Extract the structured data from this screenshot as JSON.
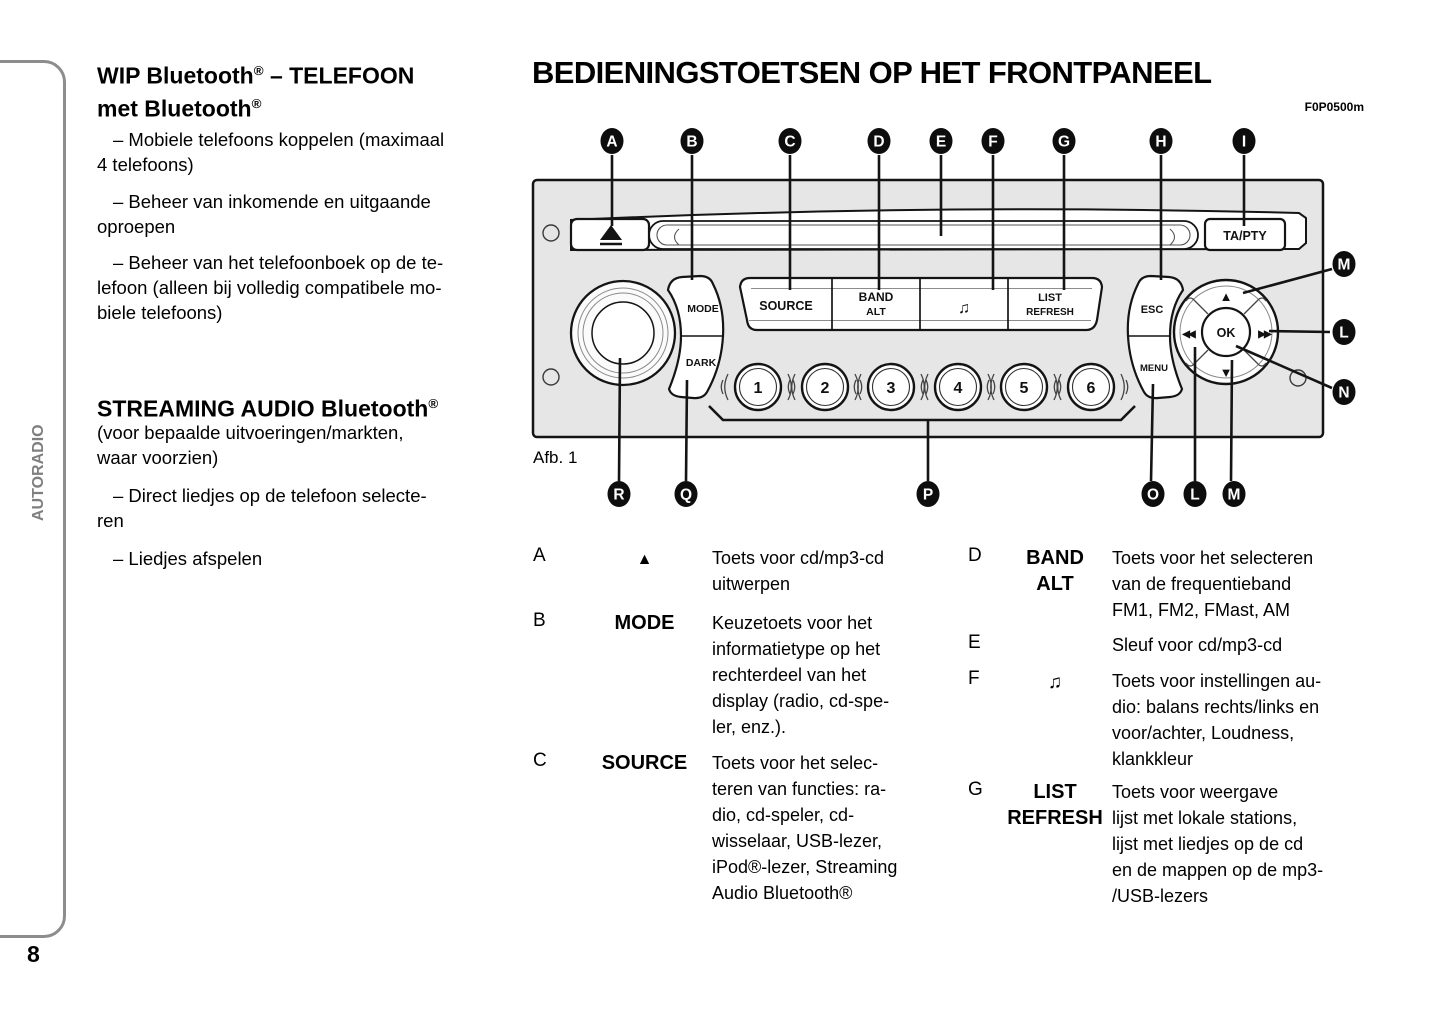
{
  "page": {
    "number": "8",
    "side_label": "AUTORADIO",
    "figure_caption": "Afb. 1",
    "figure_code": "F0P0500m"
  },
  "left_column": {
    "h1": {
      "b1": "WIP Bluetooth",
      "s1": "®",
      "b2": " – TELEFOON",
      "b3": "met Bluetooth",
      "s2": "®"
    },
    "p1": "– Mobiele telefoons koppelen (maximaal\n4 telefoons)",
    "p2": "– Beheer van inkomende en uitgaande\noproepen",
    "p3": "– Beheer van het telefoonboek op de te-\nlefoon (alleen bij volledig compatibele mo-\nbiele telefoons)",
    "h2": {
      "b1": "STREAMING AUDIO Bluetooth",
      "s1": "®"
    },
    "p4": "(voor bepaalde uitvoeringen/markten,\nwaar voorzien)",
    "p5": "– Direct liedjes op de telefoon selecte-\nren",
    "p6": "– Liedjes afspelen"
  },
  "main": {
    "title": "BEDIENINGSTOETSEN OP HET FRONTPANEEL"
  },
  "radio": {
    "eject_symbol": "▲",
    "ta_pty": "TA/PTY",
    "mode": "MODE",
    "dark": "DARK",
    "source": "SOURCE",
    "band": "BAND",
    "alt": "ALT",
    "note": "♫",
    "list": "LIST",
    "refresh": "REFRESH",
    "esc": "ESC",
    "menu": "MENU",
    "ok": "OK",
    "numbers": [
      "1",
      "2",
      "3",
      "4",
      "5",
      "6"
    ],
    "arrow_up": "▲",
    "arrow_down": "▼",
    "arrow_left": "◀◀",
    "arrow_right": "▶▶"
  },
  "callouts": {
    "top": [
      "A",
      "B",
      "C",
      "D",
      "E",
      "F",
      "G",
      "H",
      "I"
    ],
    "right": [
      "M",
      "L",
      "N"
    ],
    "bottom": [
      "R",
      "Q",
      "P",
      "O",
      "L",
      "M"
    ]
  },
  "definitions": {
    "rows": [
      {
        "letter": "A",
        "label": "▲",
        "desc": "Toets voor cd/mp3-cd\nuitwerpen"
      },
      {
        "letter": "B",
        "label": "MODE",
        "desc": "Keuzetoets voor het\ninformatietype op het\nrechterdeel van het\ndisplay (radio, cd-spe-\nler, enz.)."
      },
      {
        "letter": "C",
        "label": "SOURCE",
        "desc": "Toets voor het selec-\nteren van functies: ra-\ndio, cd-speler, cd-\nwisselaar, USB-lezer,\niPod®-lezer, Streaming\nAudio Bluetooth®"
      },
      {
        "letter": "D",
        "label": "BAND\nALT",
        "desc": "Toets voor het selecteren\nvan de frequentieband\nFM1, FM2, FMast, AM"
      },
      {
        "letter": "E",
        "label": "",
        "desc": "Sleuf voor cd/mp3-cd"
      },
      {
        "letter": "F",
        "label": "♫",
        "desc": "Toets voor instellingen au-\ndio: balans rechts/links en\nvoor/achter, Loudness,\nklankkleur"
      },
      {
        "letter": "G",
        "label": "LIST\nREFRESH",
        "desc": "Toets voor weergave\nlijst met lokale stations,\nlijst met liedjes op de cd\nen de mappen op de mp3-\n/USB-lezers"
      }
    ]
  },
  "colors": {
    "panel_fill": "#e6e6e6",
    "frame_gray": "#8d8d8d",
    "side_label_gray": "#7f7f7f"
  }
}
